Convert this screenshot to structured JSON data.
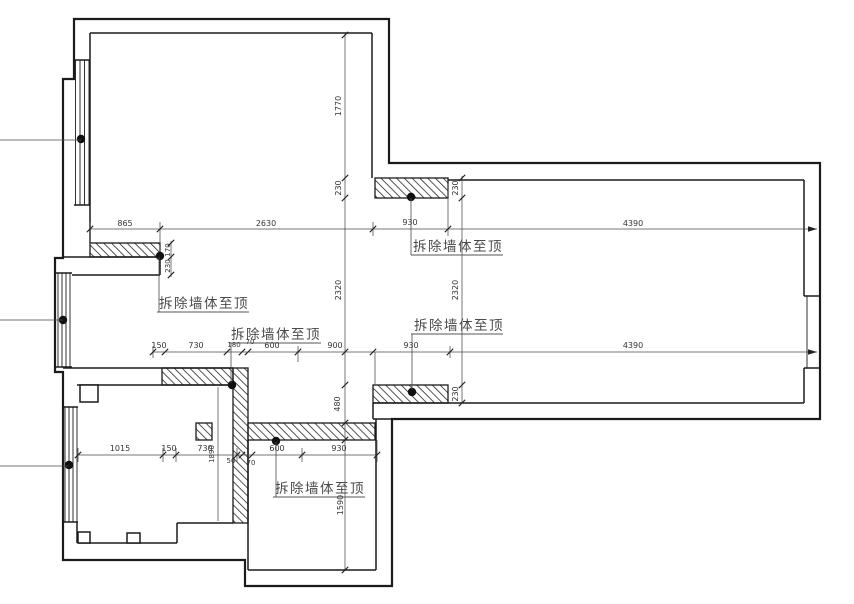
{
  "drawing": {
    "type": "floor-plan-demolition",
    "demolish_label": "拆除墙体至顶",
    "colors": {
      "wall_line": "#1b1b1b",
      "dim_text": "#333333",
      "label_text": "#4a4a4a",
      "background": "#ffffff"
    },
    "dims": {
      "top": [
        "865",
        "2630",
        "930",
        "4390"
      ],
      "mid": [
        "150",
        "730",
        "180",
        "70",
        "600",
        "900",
        "930",
        "4390"
      ],
      "bottom": [
        "1015",
        "150",
        "730",
        "1890",
        "50",
        "70",
        "600",
        "930"
      ],
      "vleft": [
        "1770",
        "230",
        "2320",
        "480",
        "1590"
      ],
      "vright": [
        "230",
        "2320",
        "230"
      ],
      "vwall": [
        "170",
        "230"
      ]
    }
  }
}
